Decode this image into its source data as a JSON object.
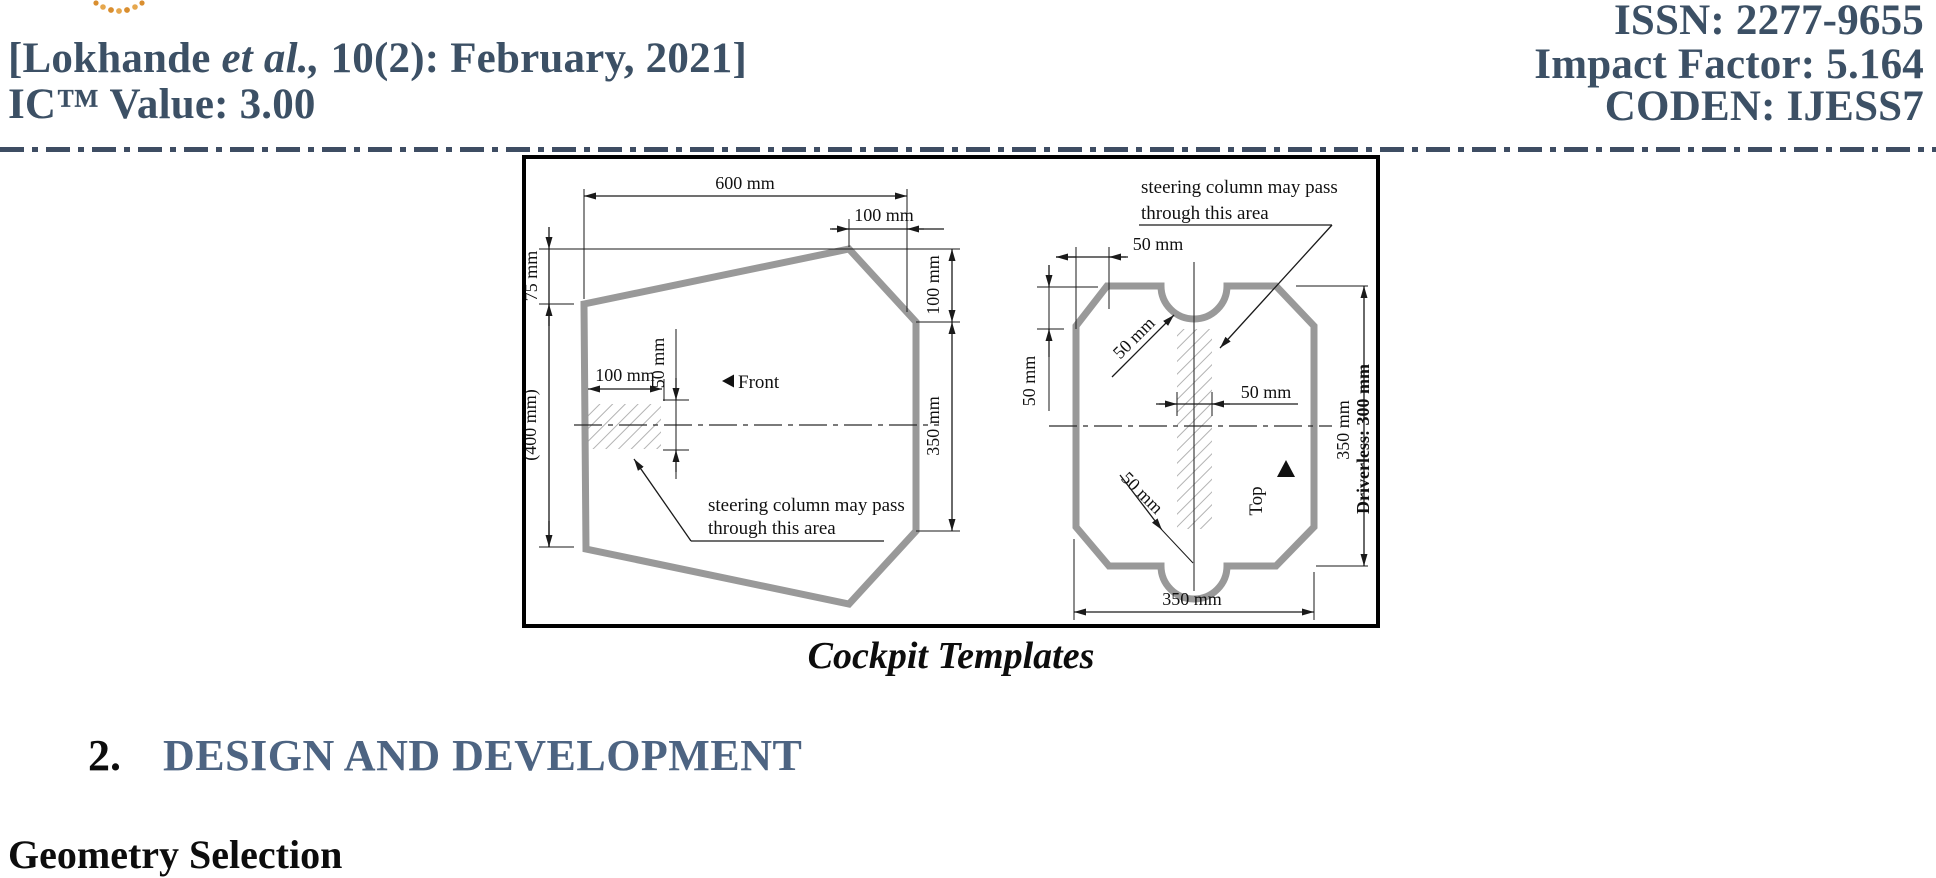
{
  "header": {
    "left_line1": {
      "prefix": "[Lokhande ",
      "italic": "et al.,",
      "suffix": " 10(2): February, 2021]"
    },
    "left_line2": "IC™ Value: 3.00",
    "right_line1": "ISSN: 2277-9655",
    "right_line2": "Impact Factor: 5.164",
    "right_line3": "CODEN: IJESS7"
  },
  "figure": {
    "caption": "Cockpit Templates",
    "left_template": {
      "dim_600": "600 mm",
      "dim_100_top": "100 mm",
      "dim_75": "75 mm",
      "dim_400": "(400 mm)",
      "dim_100_hatch": "100 mm",
      "dim_50_hatch": "50 mm",
      "dim_100_right": "100 mm",
      "dim_350_right": "350 mm",
      "front_label": "Front",
      "note_line1": "steering column may pass",
      "note_line2": "through this area"
    },
    "right_template": {
      "dim_50_top": "50 mm",
      "dim_50_left": "50 mm",
      "dim_50_notch_top": "50 mm",
      "dim_50_center": "50 mm",
      "dim_50_notch_bottom": "50 mm",
      "dim_350_right": "350 mm",
      "driverless_label": "Driverless: 300 mm",
      "top_label": "Top",
      "dim_350_bottom": "350 mm",
      "note_line1": "steering column may pass",
      "note_line2": "through this area"
    }
  },
  "section": {
    "number": "2.",
    "title": "DESIGN AND DEVELOPMENT"
  },
  "subsection": {
    "title": "Geometry Selection"
  },
  "colors": {
    "header_text": "#3c5065",
    "section_title": "#4d6482",
    "separator": "#3e4d63",
    "shape_outline": "#999999",
    "hatch": "#b3b3b3",
    "logo_dot": "#dd9a3c"
  }
}
